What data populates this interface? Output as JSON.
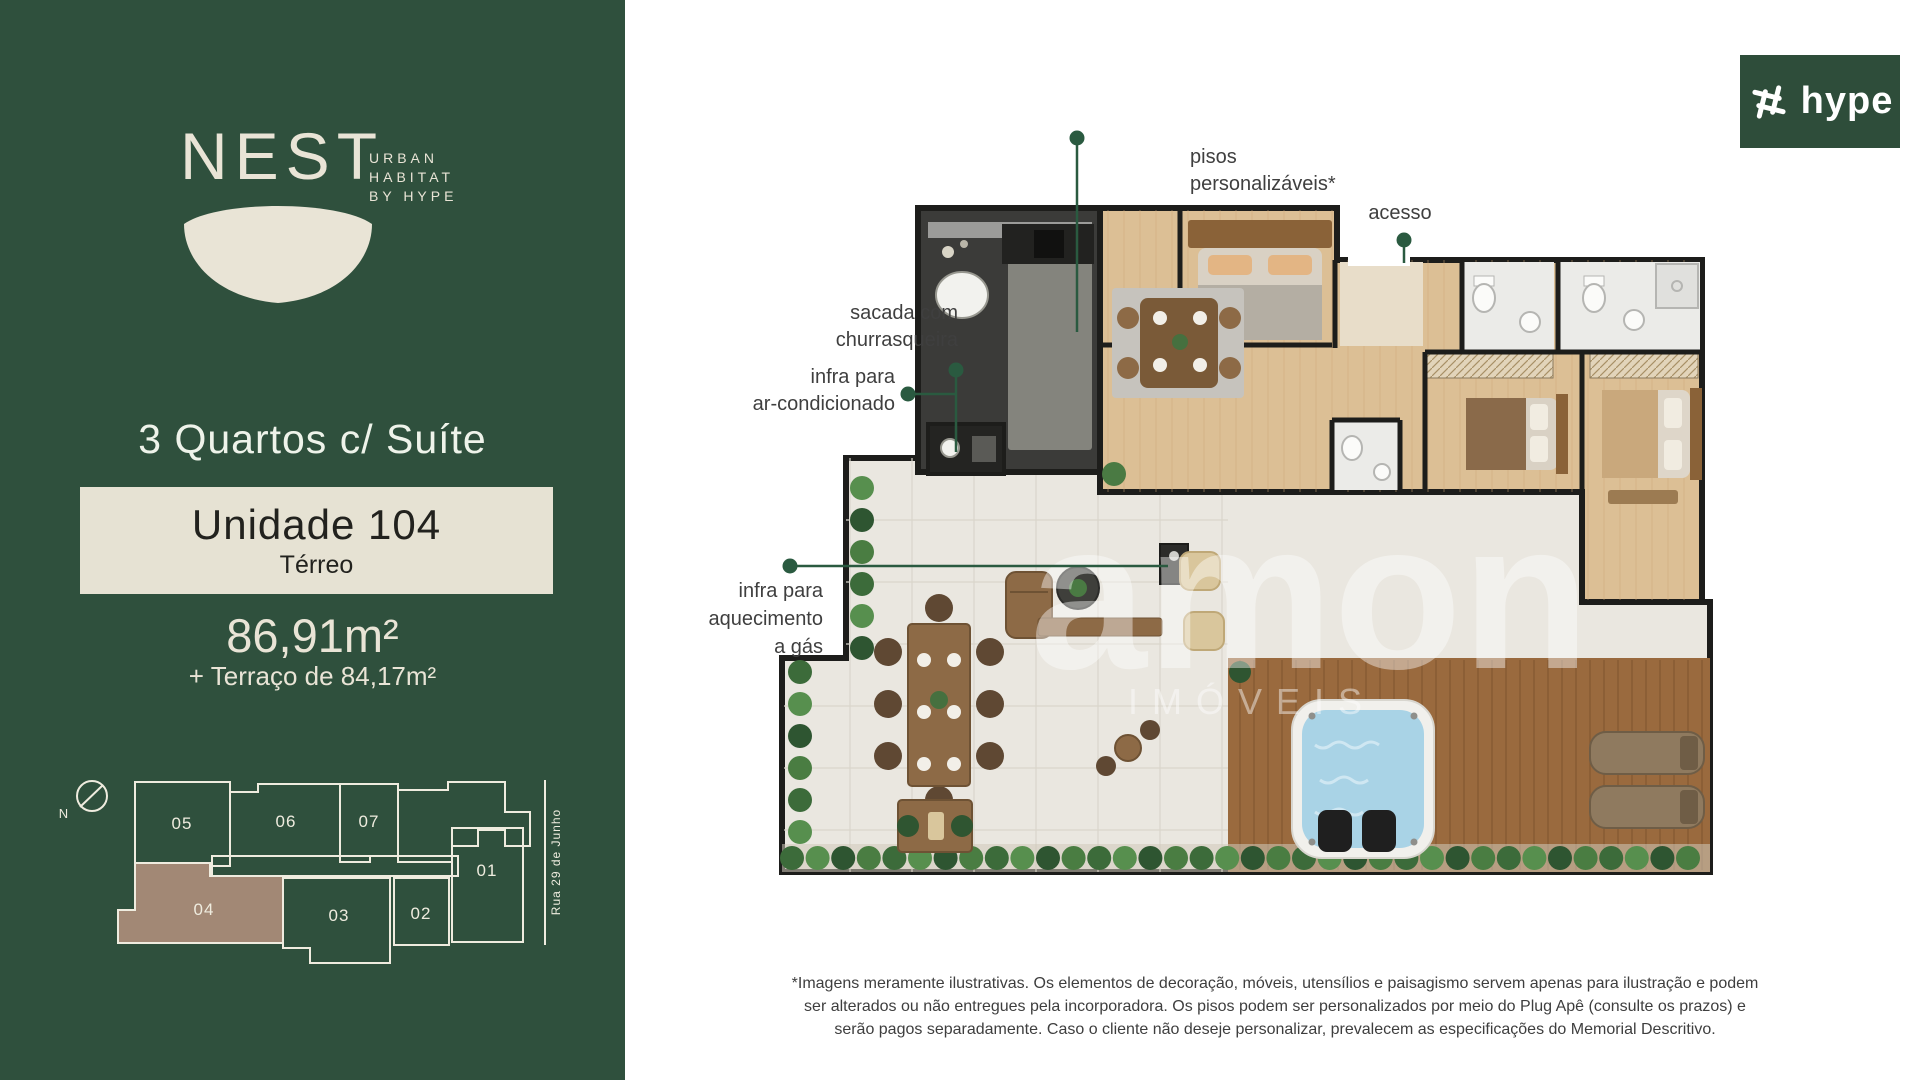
{
  "colors": {
    "sidebar_green": "#2f503d",
    "logo_green": "#2e4d3a",
    "cream": "#e9e4d6",
    "accent_green": "#2a5a40",
    "unit_highlight_brown": "#a28875",
    "wall_black": "#1d1d1b",
    "wood_floor": "#dcbf95",
    "deck_wood": "#9a6a3e",
    "pool_water": "#a9d3e6",
    "terrace_tile": "#eae7e0"
  },
  "sidebar": {
    "brand": {
      "name": "NEST",
      "tagline_line1": "URBAN",
      "tagline_line2": "HABITAT",
      "tagline_line3": "BY HYPE"
    },
    "typology": "3 Quartos c/ Suíte",
    "unit_box": {
      "title": "Unidade 104",
      "floor": "Térreo"
    },
    "area_main": "86,91m²",
    "area_terrace": "+ Terraço de 84,17m²",
    "sitemap": {
      "compass": "N",
      "street": "Rua 29 de Junho",
      "units": [
        "05",
        "06",
        "07",
        "01",
        "04",
        "03",
        "02"
      ],
      "highlighted_unit": "04"
    }
  },
  "plan": {
    "labels": {
      "pisos_line1": "pisos",
      "pisos_line2": "personalizáveis*",
      "acesso": "acesso",
      "sacada_line1": "sacada com",
      "sacada_line2": "churrasqueira",
      "infra_ar_line1": "infra para",
      "infra_ar_line2": "ar-condicionado",
      "infra_gas_line1": "infra para",
      "infra_gas_line2": "aquecimento",
      "infra_gas_line3": "a gás"
    },
    "watermark": {
      "name": "amon",
      "sub": "IMÓVEIS"
    }
  },
  "hype_logo": {
    "text": "hype"
  },
  "disclaimer": {
    "line1": "*Imagens meramente ilustrativas. Os elementos de decoração, móveis, utensílios e paisagismo servem apenas para ilustração e podem",
    "line2": "ser alterados ou não entregues pela incorporadora. Os pisos podem ser personalizados por meio do Plug Apê (consulte os prazos) e",
    "line3": "serão pagos separadamente. Caso o cliente não deseje personalizar, prevalecem as especificações do Memorial Descritivo."
  }
}
